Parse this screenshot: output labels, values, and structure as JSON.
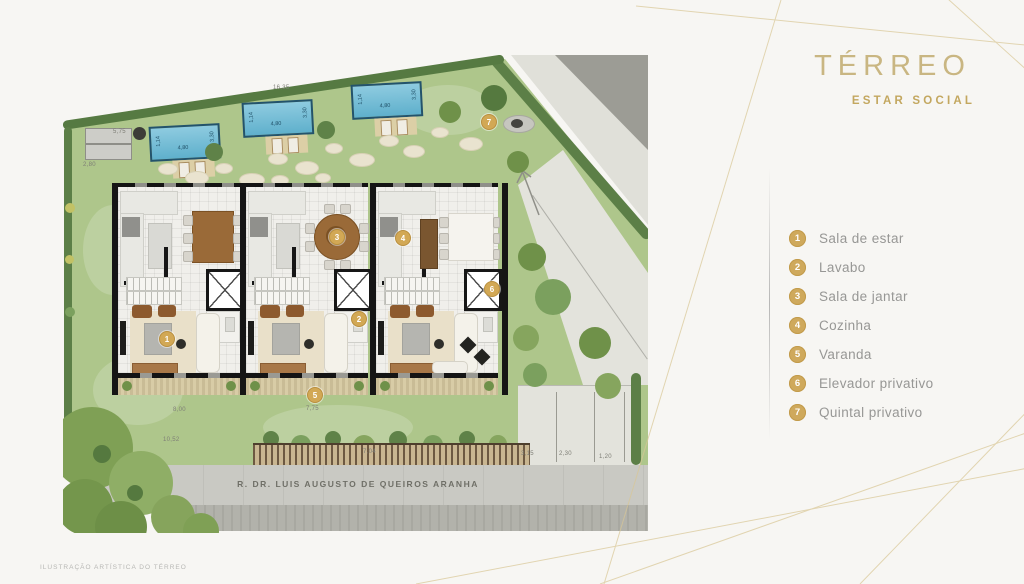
{
  "panel": {
    "title": "TÉRREO",
    "subtitle": "ESTAR SOCIAL",
    "legend": [
      {
        "num": "1",
        "label": "Sala de estar"
      },
      {
        "num": "2",
        "label": "Lavabo"
      },
      {
        "num": "3",
        "label": "Sala de jantar"
      },
      {
        "num": "4",
        "label": "Cozinha"
      },
      {
        "num": "5",
        "label": "Varanda"
      },
      {
        "num": "6",
        "label": "Elevador privativo"
      },
      {
        "num": "7",
        "label": "Quintal privativo"
      }
    ]
  },
  "plan": {
    "street_label": "R. DR. LUIS AUGUSTO DE QUEIROS ARANHA",
    "caption": "ILUSTRAÇÃO ARTÍSTICA DO TÉRREO",
    "markers": [
      "1",
      "2",
      "3",
      "4",
      "5",
      "6",
      "7"
    ],
    "pool_labels": {
      "width": "1,14",
      "length": "4,80",
      "side": "3,30"
    },
    "dimensions": {
      "top": "16,35",
      "upper_left": "5,75",
      "left": "2,80",
      "lawn_left": "8,00",
      "lawn_center": "7,75",
      "lawn_bottom": "10,52",
      "fence": "7,04",
      "parking_1": "3,15",
      "parking_2": "2,30",
      "parking_3": "1,20"
    }
  },
  "colors": {
    "accent_gold": "#c9b682",
    "legend_badge": "#cfa95c",
    "lawn": "#aec68b",
    "pool": "#5fb0cc"
  }
}
